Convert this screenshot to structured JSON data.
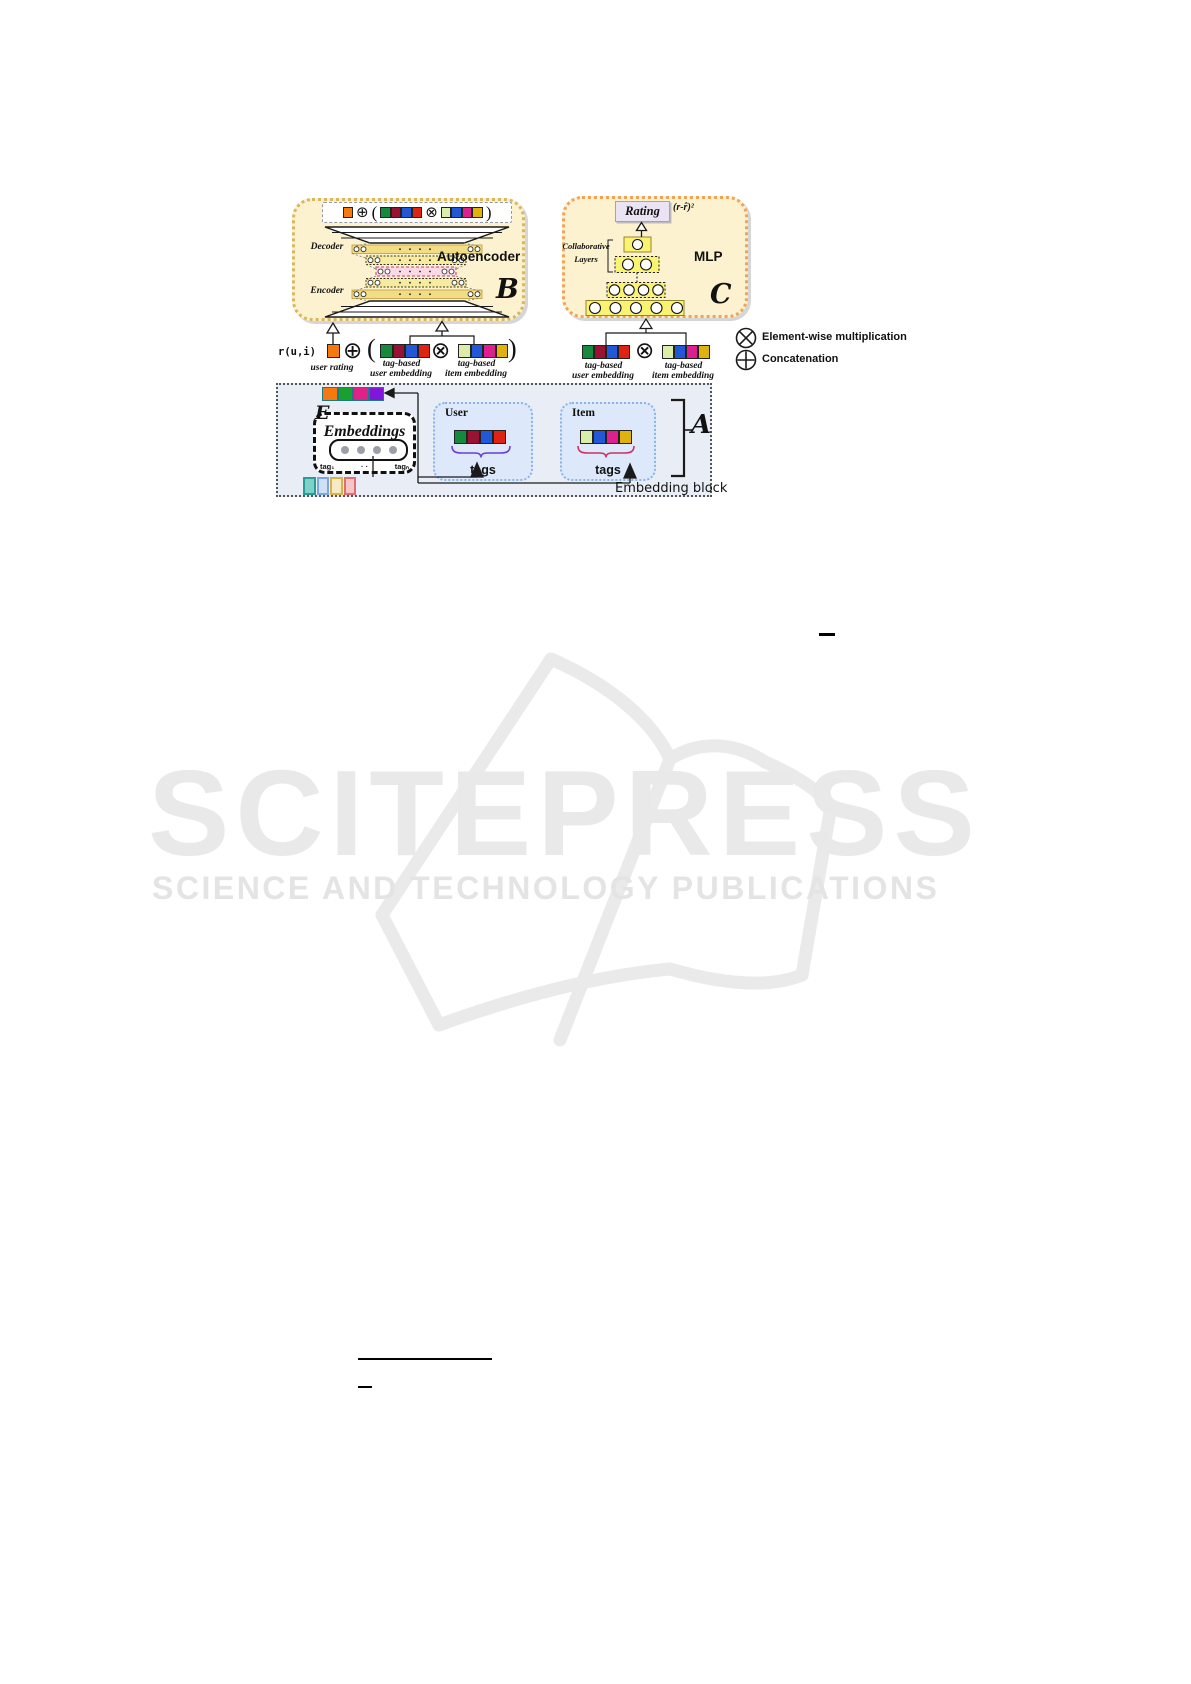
{
  "figure": {
    "autoencoder": {
      "title": "Autoencoder",
      "letter": "B",
      "decoder": "Decoder",
      "encoder": "Encoder"
    },
    "mlp": {
      "title": "MLP",
      "letter": "C",
      "rating": "Rating",
      "loss": "(r-r̂)²",
      "collab_line1": "Collaborative",
      "collab_line2": "Layers"
    },
    "embedding": {
      "label": "Embedding block",
      "letter": "A",
      "e_letter": "E",
      "embeddings": "Embeddings",
      "tag_first": "tag₁",
      "tag_dots": "· ·",
      "tag_last": "tagₙ",
      "user_title": "User",
      "item_title": "Item",
      "tags": "tags"
    },
    "input": {
      "rui": "r(u,i)",
      "user_rating": "user rating",
      "tag_based": "tag-based",
      "user_embedding": "user embedding",
      "item_embedding": "item embedding",
      "paren_open": "(",
      "paren_close": ")"
    },
    "symbols": {
      "oplus": "⊕",
      "otimes": "⊗"
    },
    "legend": {
      "multiplication": "Element-wise multiplication",
      "concatenation": "Concatenation"
    },
    "mlp_layers": [
      1,
      2,
      4,
      5
    ],
    "colors": {
      "user_embedding": [
        "#168a3c",
        "#991231",
        "#2257d6",
        "#df2312"
      ],
      "item_embedding": [
        "#dcedaa",
        "#2257d6",
        "#de1f8e",
        "#dfb30b"
      ],
      "user_rating": [
        "#f5790f"
      ],
      "e_vector": [
        "#f5790f",
        "#18a12f",
        "#e0218a",
        "#8016d9"
      ],
      "e_vector_border": "#1d7a80",
      "pill_dots": [
        "#9aa0a6",
        "#9aa0a6",
        "#9aa0a6",
        "#9aa0a6"
      ],
      "tag_squares": [
        "#7ed0c8",
        "#cfe0f5",
        "#f7e9c4",
        "#f6c6c6"
      ],
      "tag_squares_border": [
        "#279d93",
        "#7aa7dd",
        "#d6b44a",
        "#e26b74"
      ],
      "block_b_bg": "#fcf2cf",
      "block_b_border": "#d9b75f",
      "block_c_bg": "#fcf2cf",
      "block_c_border": "#f0a35a",
      "block_a_bg": "#e9eef6",
      "user_item_box_bg": "#dde9fb",
      "user_item_box_border": "#8ab4e8",
      "rating_bg": "#e9e3f3",
      "layer_fill": "#faf271",
      "brace_user": "#6a3fd8",
      "brace_item": "#cc3366"
    }
  },
  "watermark": {
    "logo": "SCITEPRESS",
    "subtitle": "SCIENCE AND TECHNOLOGY PUBLICATIONS",
    "color": "#e9e9e9"
  }
}
